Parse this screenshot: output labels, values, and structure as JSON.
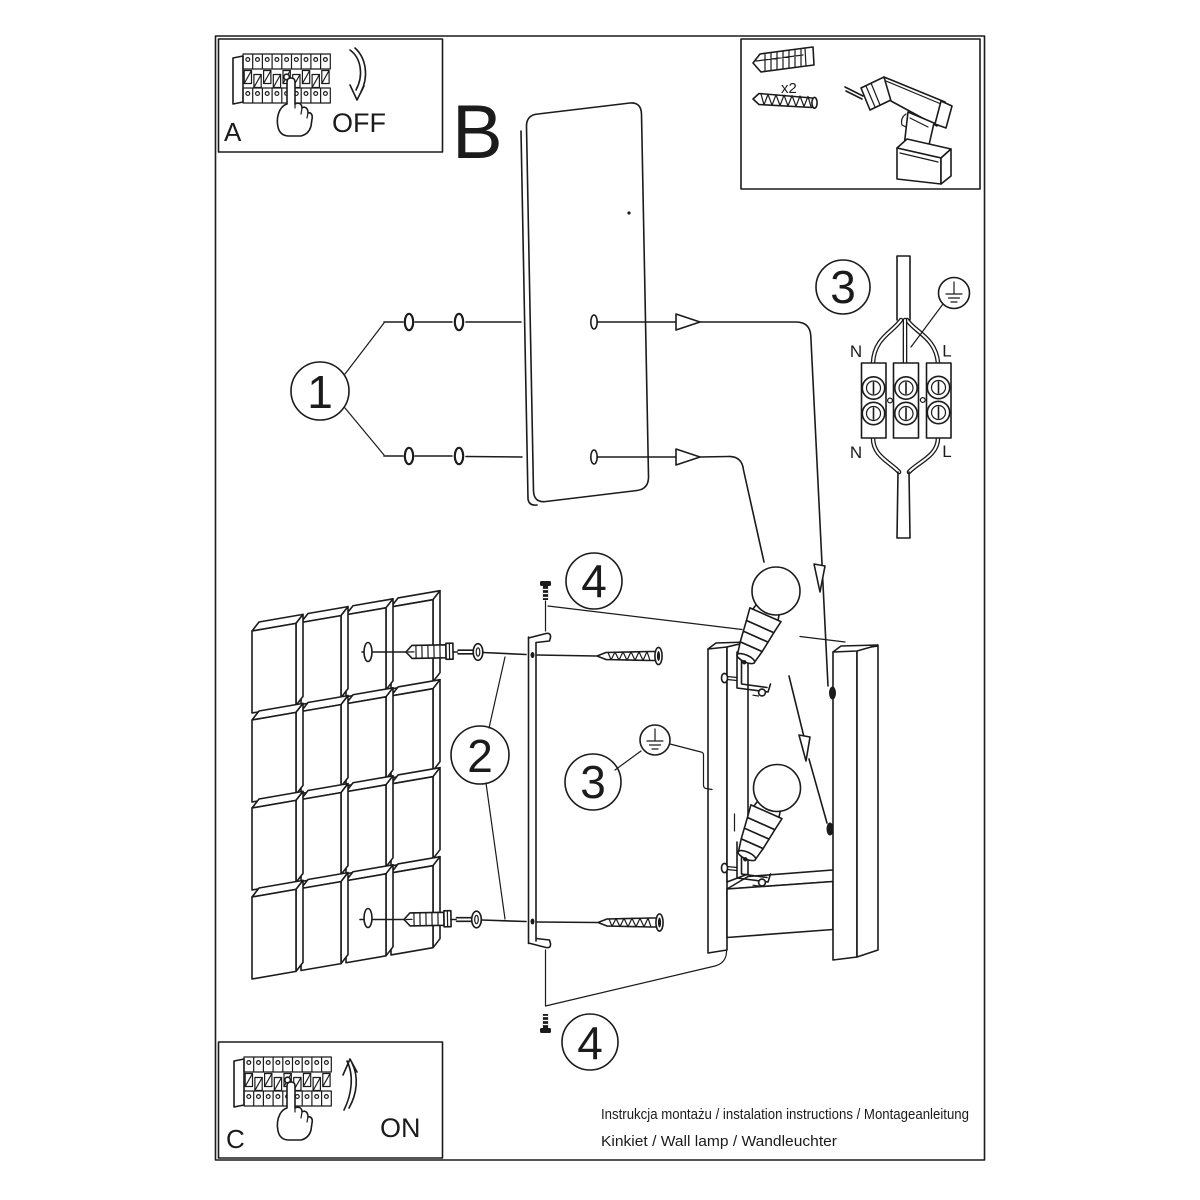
{
  "footer": {
    "line1": "Instrukcja montażu / instalation instructions / Montageanleitung",
    "line2": "Kinkiet / Wall lamp / Wandleuchter"
  },
  "steps": {
    "a": {
      "letter": "A",
      "label": "OFF"
    },
    "b": {
      "letter": "B"
    },
    "c": {
      "letter": "C",
      "label": "ON"
    }
  },
  "callouts": {
    "one": "1",
    "two": "2",
    "three": "3",
    "four": "4"
  },
  "hardware": {
    "anchor_count": "x2"
  },
  "wiring": {
    "n_top": "N",
    "l_top": "L",
    "n_bottom": "N",
    "l_bottom": "L"
  }
}
